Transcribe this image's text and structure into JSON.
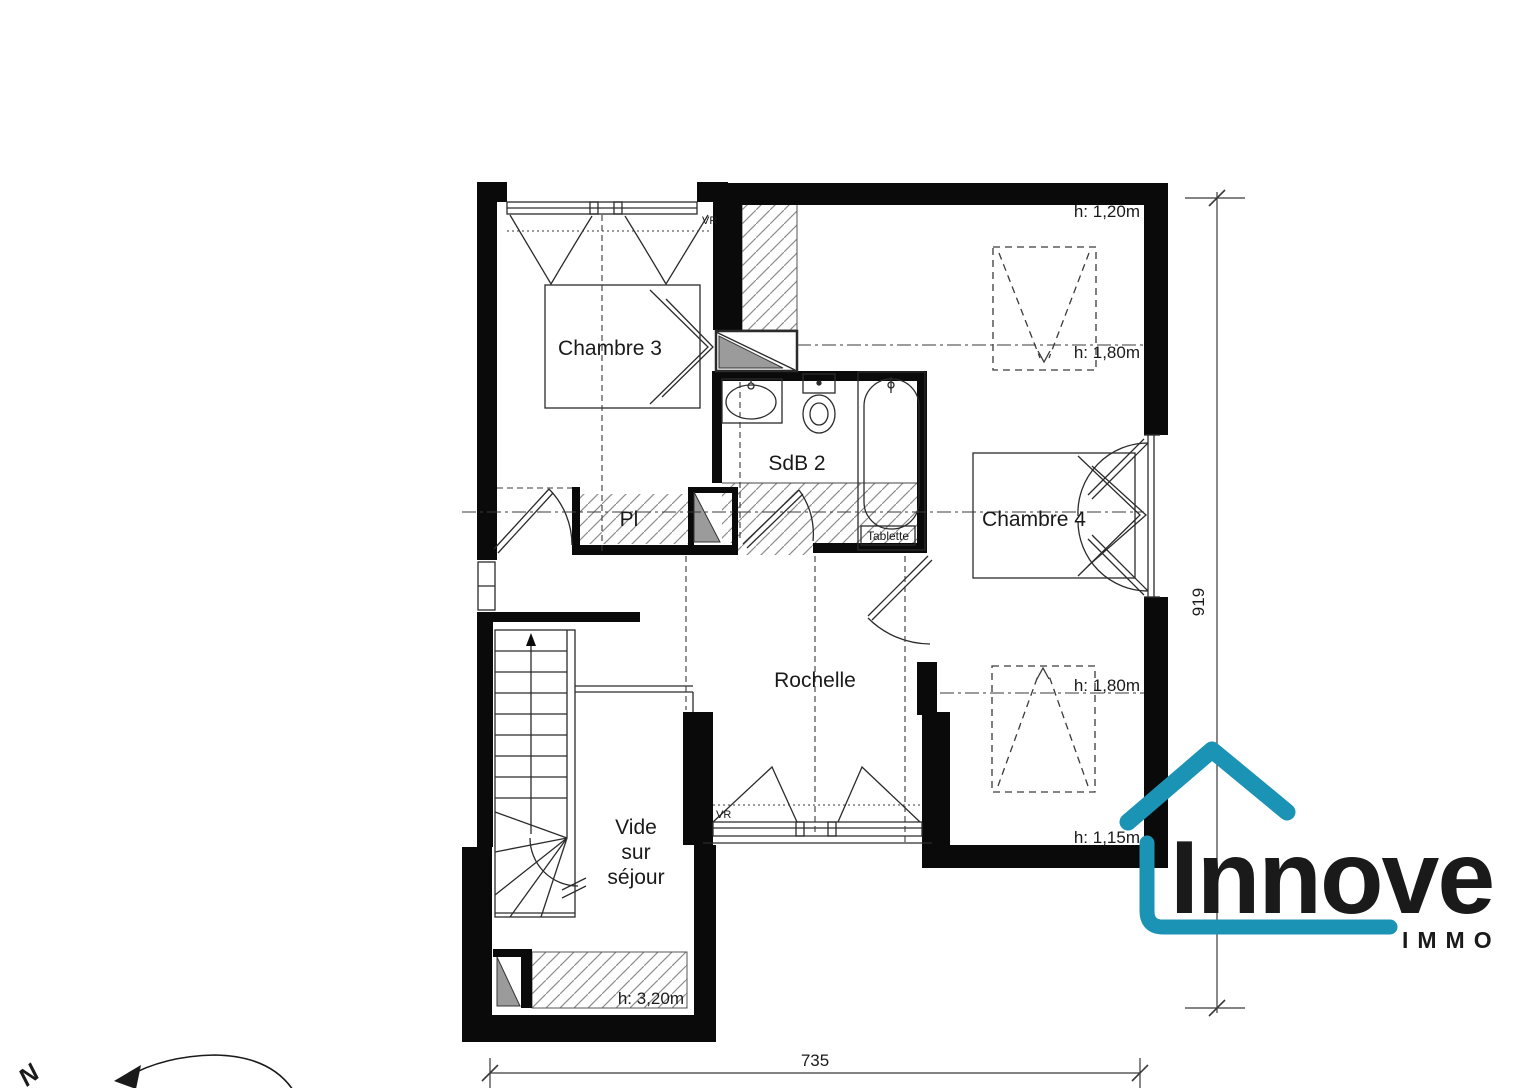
{
  "rooms": {
    "chambre3": "Chambre 3",
    "sdb2": "SdB 2",
    "pl": "Pl",
    "chambre4": "Chambre 4",
    "rochelle": "Rochelle",
    "vide": [
      "Vide",
      "sur",
      "séjour"
    ]
  },
  "annotations": {
    "h120": "h: 1,20m",
    "h180a": "h: 1,80m",
    "h180b": "h: 1,80m",
    "h115": "h: 1,15m",
    "h320": "h: 3,20m",
    "tablette": "Tablette",
    "vr_top": "VR",
    "vr_bottom": "VR"
  },
  "dimensions": {
    "width_cm": "735",
    "height_cm": "919"
  },
  "compass": {
    "north": "N"
  },
  "logo": {
    "name": "Innove",
    "tagline": "IMMO",
    "color": "#1b93b4"
  }
}
